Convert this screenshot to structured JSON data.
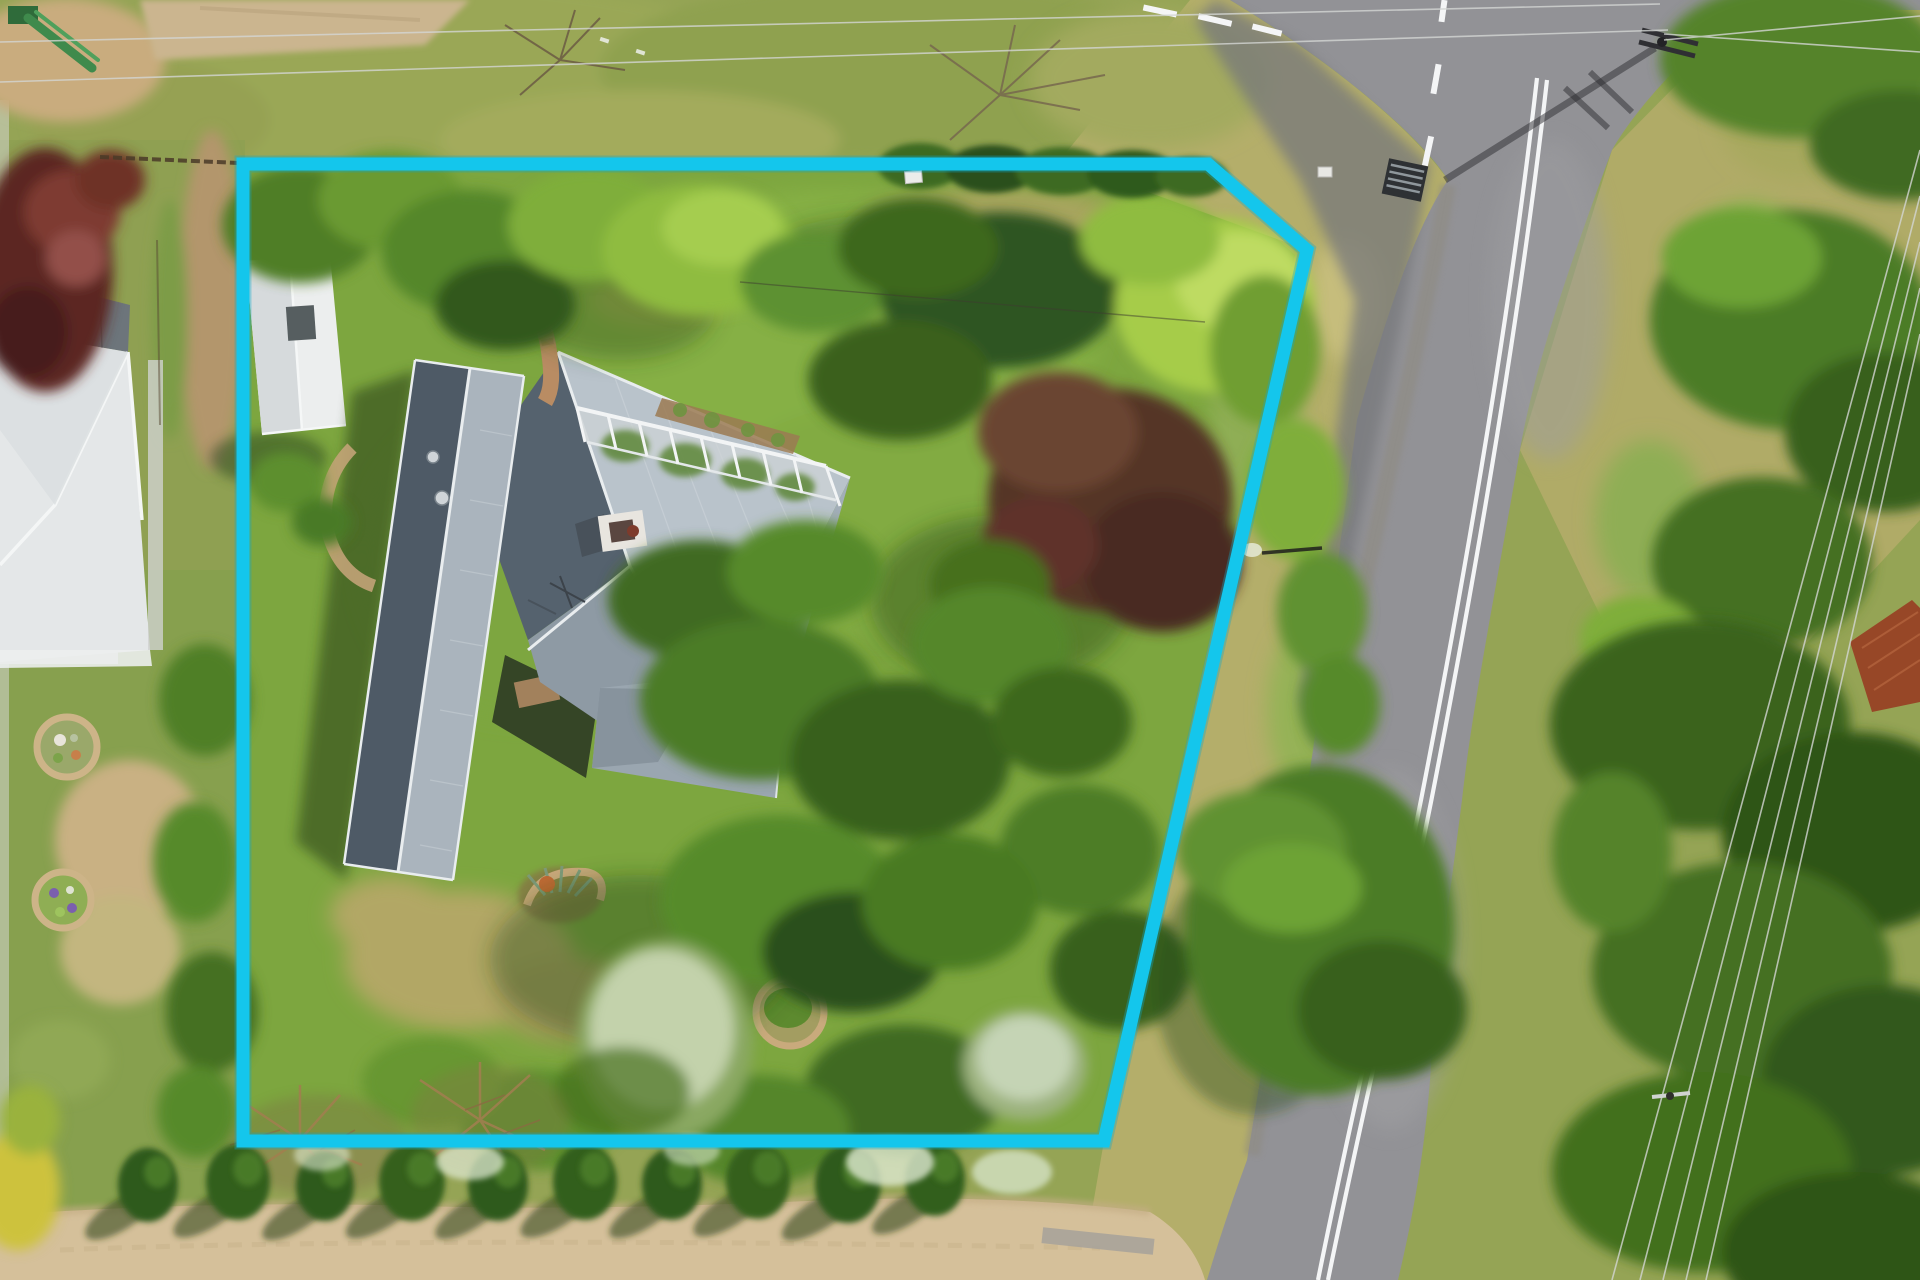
{
  "scene": {
    "kind": "aerial-drone-photo",
    "subject": "residential property with highlighted lot boundary",
    "boundary": {
      "points": "243,164 1208,164 1307,250 1104,1141 243,1141",
      "sides": 5,
      "style": "solid"
    },
    "counts": {
      "hedge_trees_bottom_row": 10,
      "powerline_wires_right": 5,
      "garden_circle_beds_neighbor": 2
    }
  },
  "colors": {
    "boundary": "#14c6ec",
    "boundary_glow": "#0ea8cc",
    "asphalt": "#929296",
    "asphalt_dark": "#77787c",
    "road_marking": "#f4f5f6",
    "lawn": "#7da63f",
    "lawn_bright": "#86b045",
    "grass_olive": "#95a455",
    "verge_grass": "#b4ae6a",
    "roof_light": "#b9c3cb",
    "roof_mid": "#8e9aa4",
    "roof_dark": "#55626e",
    "roof_trim": "#e9edef",
    "neighbor_roof": "#e4e7e8",
    "neighbor_roof_dark": "#6d757b",
    "shed_roof": "#eceeee",
    "driveway_gravel": "#d5c09a",
    "brick_path": "#b98c63",
    "hedge_dark_green": "#2f5a1d",
    "canopy_dark": "#3a641d",
    "canopy_mid": "#578a2b",
    "canopy_bright": "#a6cc49",
    "silver_tree": "#ccd9b8",
    "maroon_tree": "#553627",
    "red_tree": "#5c2624",
    "rust_roof": "#974727",
    "wire": "#d4d6d4",
    "pole_shadow": "#2c2c30"
  }
}
